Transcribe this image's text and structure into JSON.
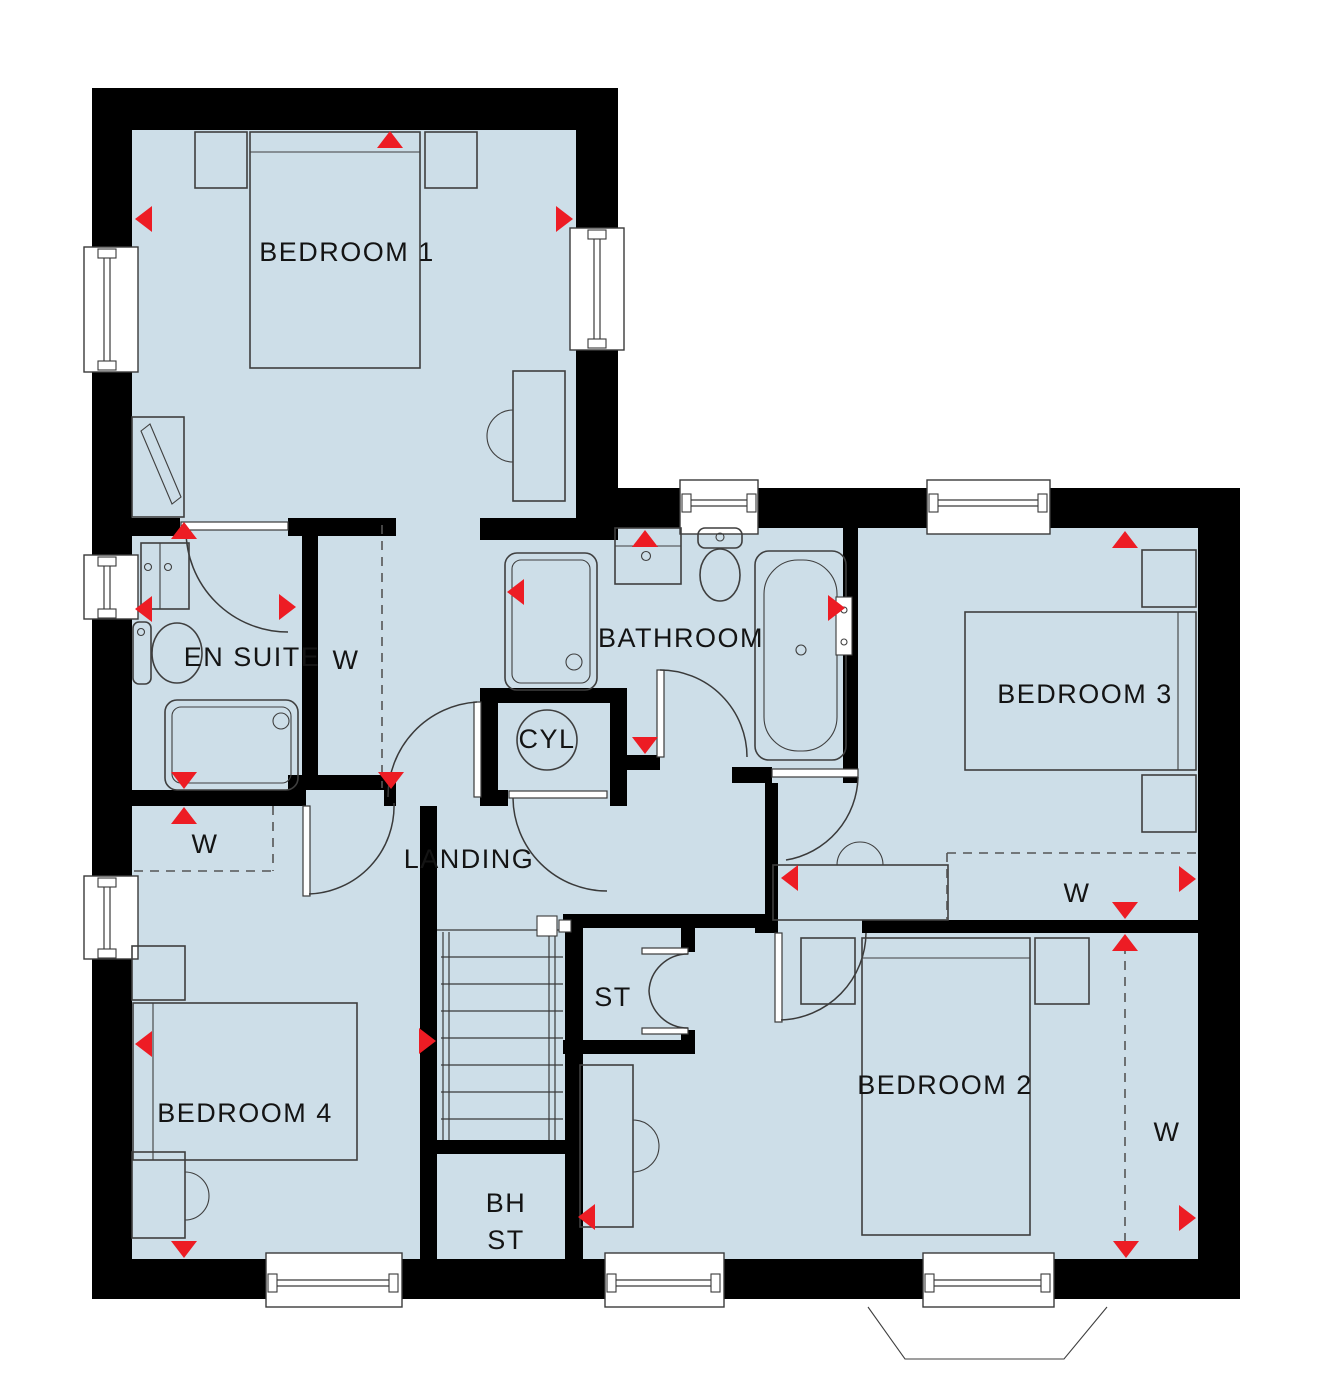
{
  "plan": {
    "type": "floor-plan",
    "colors": {
      "floor": "#cddee8",
      "wall": "#000000",
      "red": "#ed1c24",
      "line": "#3f3f3f"
    },
    "labels": [
      {
        "id": "bedroom-1",
        "text": "BEDROOM 1",
        "x": 347,
        "y": 261,
        "size": 27
      },
      {
        "id": "en-suite",
        "text": "EN SUITE",
        "x": 252,
        "y": 666,
        "size": 27
      },
      {
        "id": "wardrobe-bedroom-1",
        "text": "W",
        "x": 346,
        "y": 669,
        "size": 29
      },
      {
        "id": "bathroom",
        "text": "BATHROOM",
        "x": 681,
        "y": 647,
        "size": 27
      },
      {
        "id": "cylinder-cupboard",
        "text": "CYL",
        "x": 547,
        "y": 748,
        "size": 21
      },
      {
        "id": "bedroom-3",
        "text": "BEDROOM 3",
        "x": 1085,
        "y": 703,
        "size": 27
      },
      {
        "id": "wardrobe-bedroom-3",
        "text": "W",
        "x": 1077,
        "y": 902,
        "size": 29
      },
      {
        "id": "landing",
        "text": "LANDING",
        "x": 469,
        "y": 868,
        "size": 27
      },
      {
        "id": "wardrobe-bedroom-4",
        "text": "W",
        "x": 205,
        "y": 853,
        "size": 29
      },
      {
        "id": "store",
        "text": "ST",
        "x": 613,
        "y": 1006,
        "size": 27
      },
      {
        "id": "bedroom-4",
        "text": "BEDROOM 4",
        "x": 245,
        "y": 1122,
        "size": 27
      },
      {
        "id": "bulkhead-store-line1",
        "text": "BH",
        "x": 506,
        "y": 1212,
        "size": 27
      },
      {
        "id": "bulkhead-store-line2",
        "text": "ST",
        "x": 506,
        "y": 1249,
        "size": 27
      },
      {
        "id": "bedroom-2",
        "text": "BEDROOM 2",
        "x": 945,
        "y": 1094,
        "size": 27
      },
      {
        "id": "wardrobe-bedroom-2",
        "text": "W",
        "x": 1167,
        "y": 1141,
        "size": 29
      }
    ],
    "markers": [
      {
        "x": 390,
        "y": 131,
        "dir": "up"
      },
      {
        "x": 135,
        "y": 219,
        "dir": "left"
      },
      {
        "x": 573,
        "y": 219,
        "dir": "right"
      },
      {
        "x": 184,
        "y": 522,
        "dir": "up"
      },
      {
        "x": 135,
        "y": 609,
        "dir": "left"
      },
      {
        "x": 296,
        "y": 607,
        "dir": "right"
      },
      {
        "x": 184,
        "y": 789,
        "dir": "down"
      },
      {
        "x": 184,
        "y": 807,
        "dir": "up"
      },
      {
        "x": 391,
        "y": 789,
        "dir": "down"
      },
      {
        "x": 645,
        "y": 530,
        "dir": "up"
      },
      {
        "x": 507,
        "y": 592,
        "dir": "left"
      },
      {
        "x": 845,
        "y": 608,
        "dir": "right"
      },
      {
        "x": 645,
        "y": 754,
        "dir": "down"
      },
      {
        "x": 1125,
        "y": 531,
        "dir": "up"
      },
      {
        "x": 1196,
        "y": 879,
        "dir": "right"
      },
      {
        "x": 1125,
        "y": 919,
        "dir": "down"
      },
      {
        "x": 1125,
        "y": 934,
        "dir": "up"
      },
      {
        "x": 781,
        "y": 878,
        "dir": "left"
      },
      {
        "x": 436,
        "y": 1041,
        "dir": "right"
      },
      {
        "x": 135,
        "y": 1044,
        "dir": "left"
      },
      {
        "x": 184,
        "y": 1258,
        "dir": "down"
      },
      {
        "x": 578,
        "y": 1217,
        "dir": "left"
      },
      {
        "x": 1126,
        "y": 1258,
        "dir": "down"
      },
      {
        "x": 1196,
        "y": 1218,
        "dir": "right"
      }
    ]
  }
}
